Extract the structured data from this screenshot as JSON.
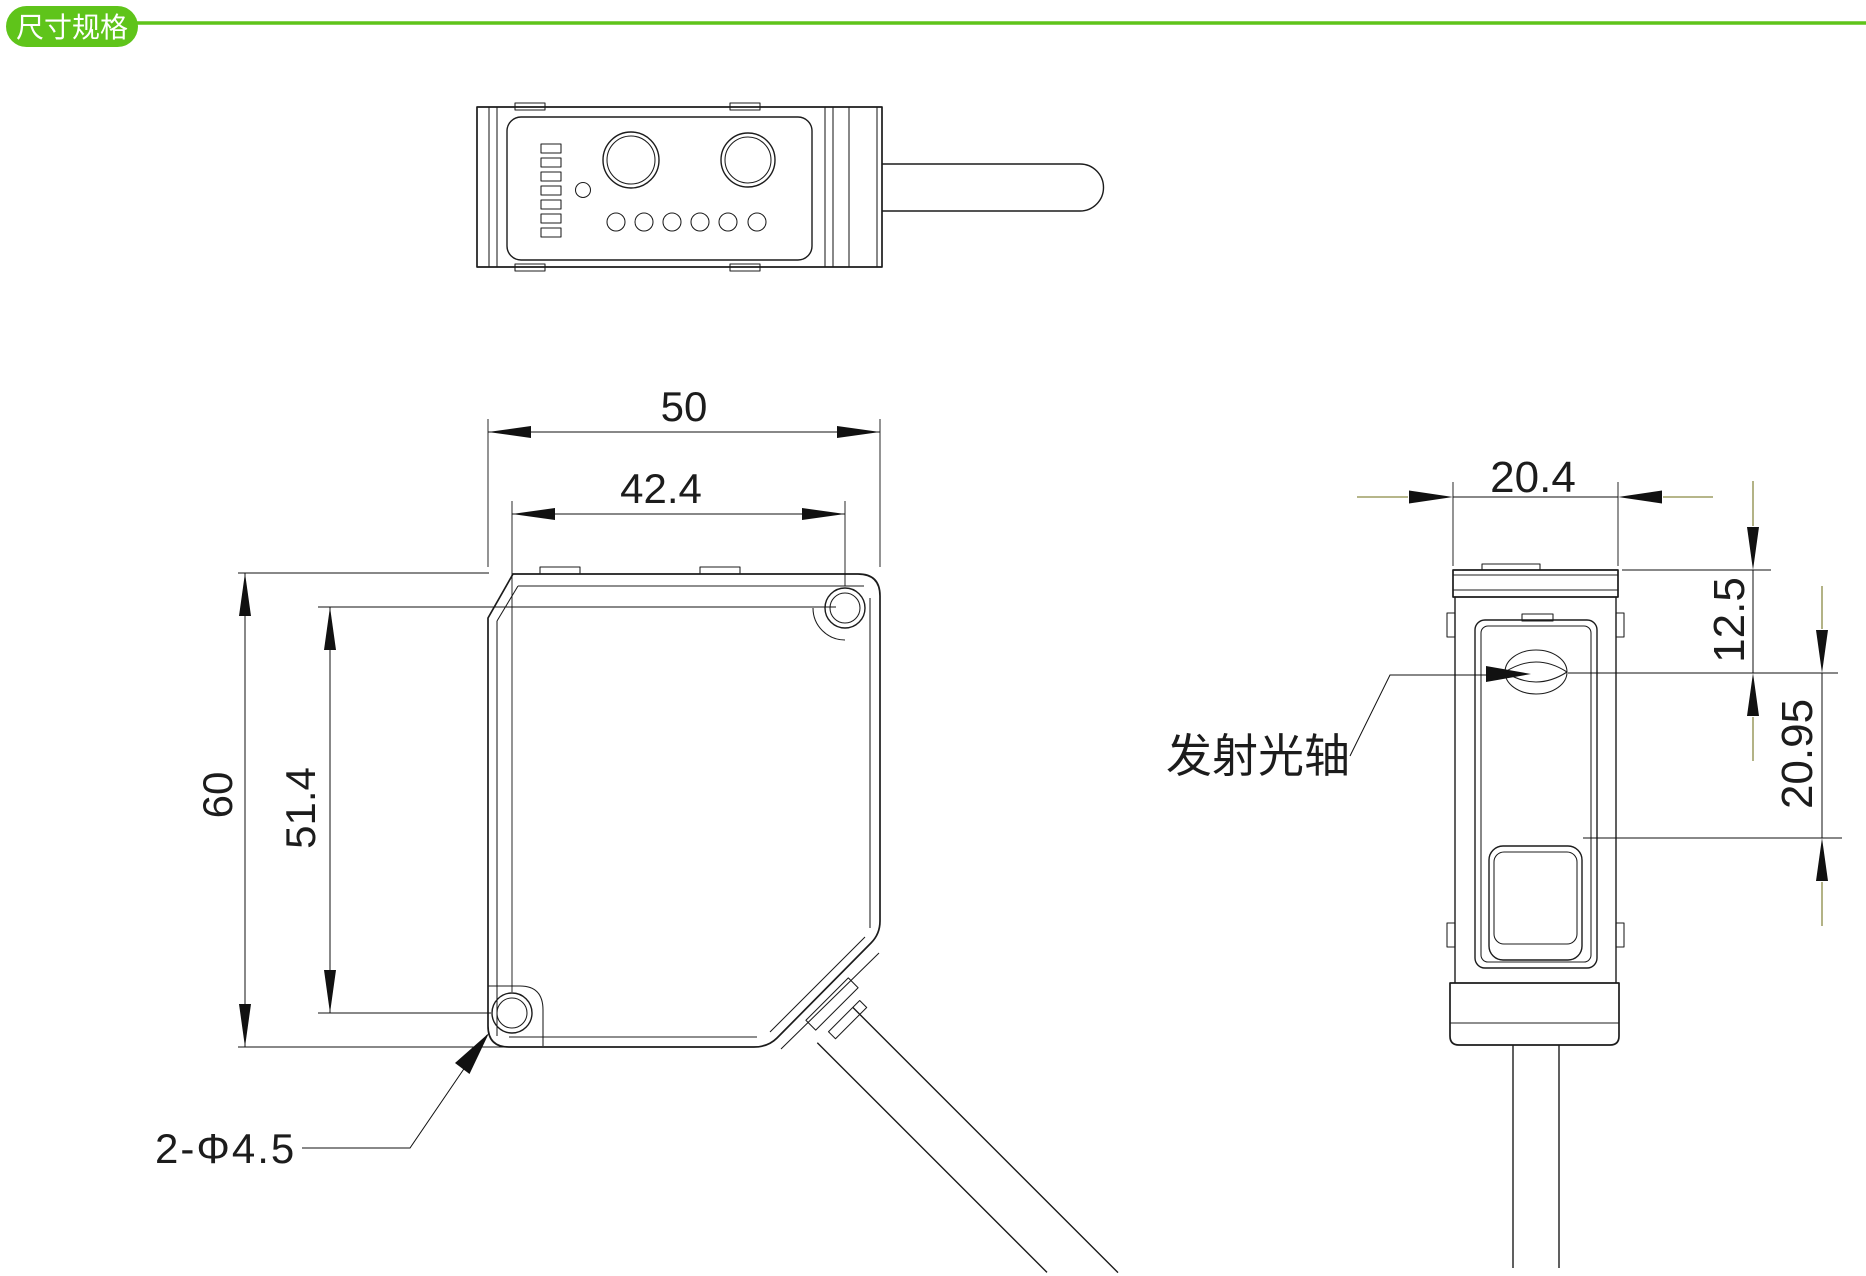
{
  "header": {
    "badge_label": "尺寸规格"
  },
  "colors": {
    "accent_green": "#5FC41A",
    "line": "#1C1C1C",
    "dimension": "#111111",
    "tail_olive": "#8A8A45"
  },
  "front_view": {
    "width": "50",
    "hole_span_width": "42.4",
    "height": "60",
    "hole_span_height": "51.4",
    "holes_label": "2-Φ4.5"
  },
  "side_view": {
    "width": "20.4",
    "axis_from_top": "12.5",
    "axis_to_window": "20.95",
    "emission_axis_label": "发射光轴"
  }
}
